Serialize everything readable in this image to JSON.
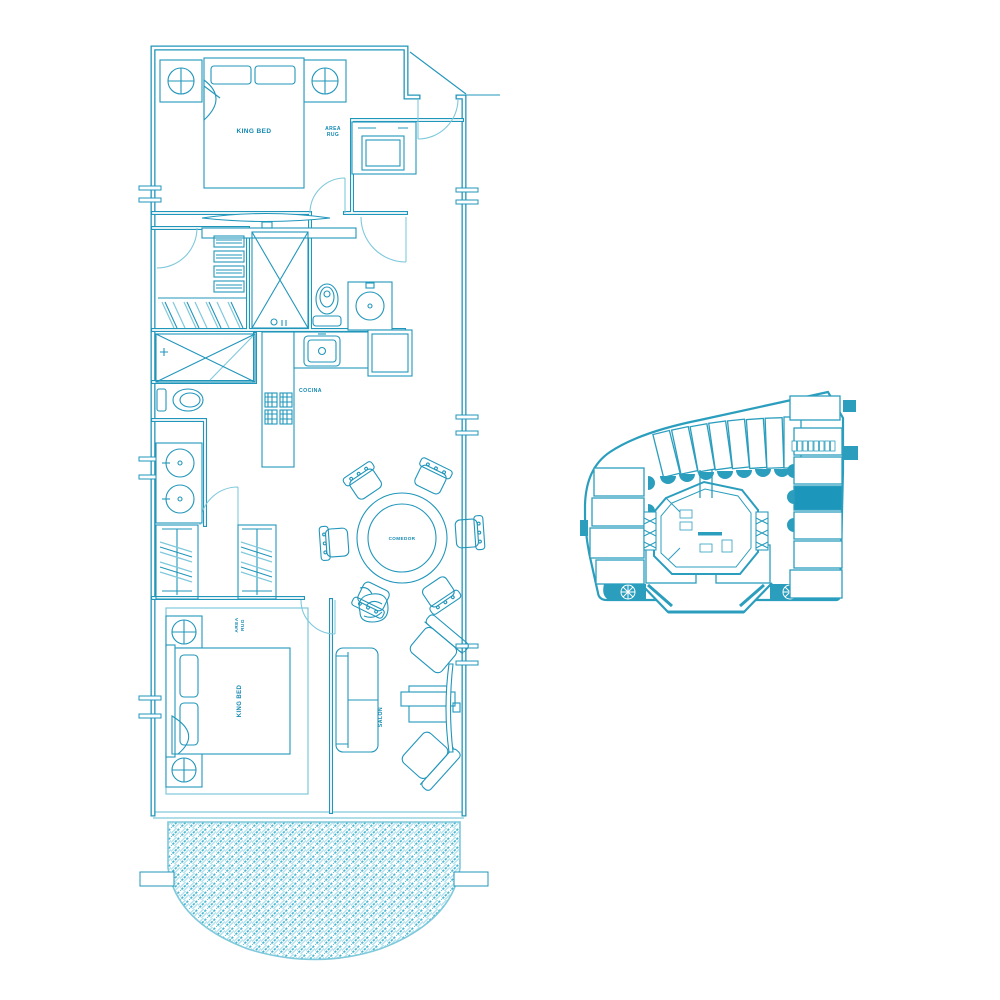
{
  "document": {
    "type": "architectural-floor-plan",
    "style": "teal blueprint on white"
  },
  "colors": {
    "line_teal": "#2196bb",
    "line_teal_light": "#7fc9dc",
    "label_teal": "#1287b0",
    "keyplan_fill": "#2b9ebe",
    "keyplan_highlight": "#1d96bb",
    "background": "#ffffff"
  },
  "floor_plan": {
    "labels": {
      "king_bed_top": "KING BED",
      "area_rug_top_1": "AREA",
      "area_rug_top_2": "RUG",
      "cocina": "COCINA",
      "comedor": "COMEDOR",
      "king_bed_bottom": "KING BED",
      "area_rug_bottom_1": "AREA",
      "area_rug_bottom_2": "RUG",
      "salon": "SALON"
    }
  },
  "key_plan": {
    "description": "building overview with one unit highlighted",
    "highlighted_unit_color": "#1d96bb"
  }
}
